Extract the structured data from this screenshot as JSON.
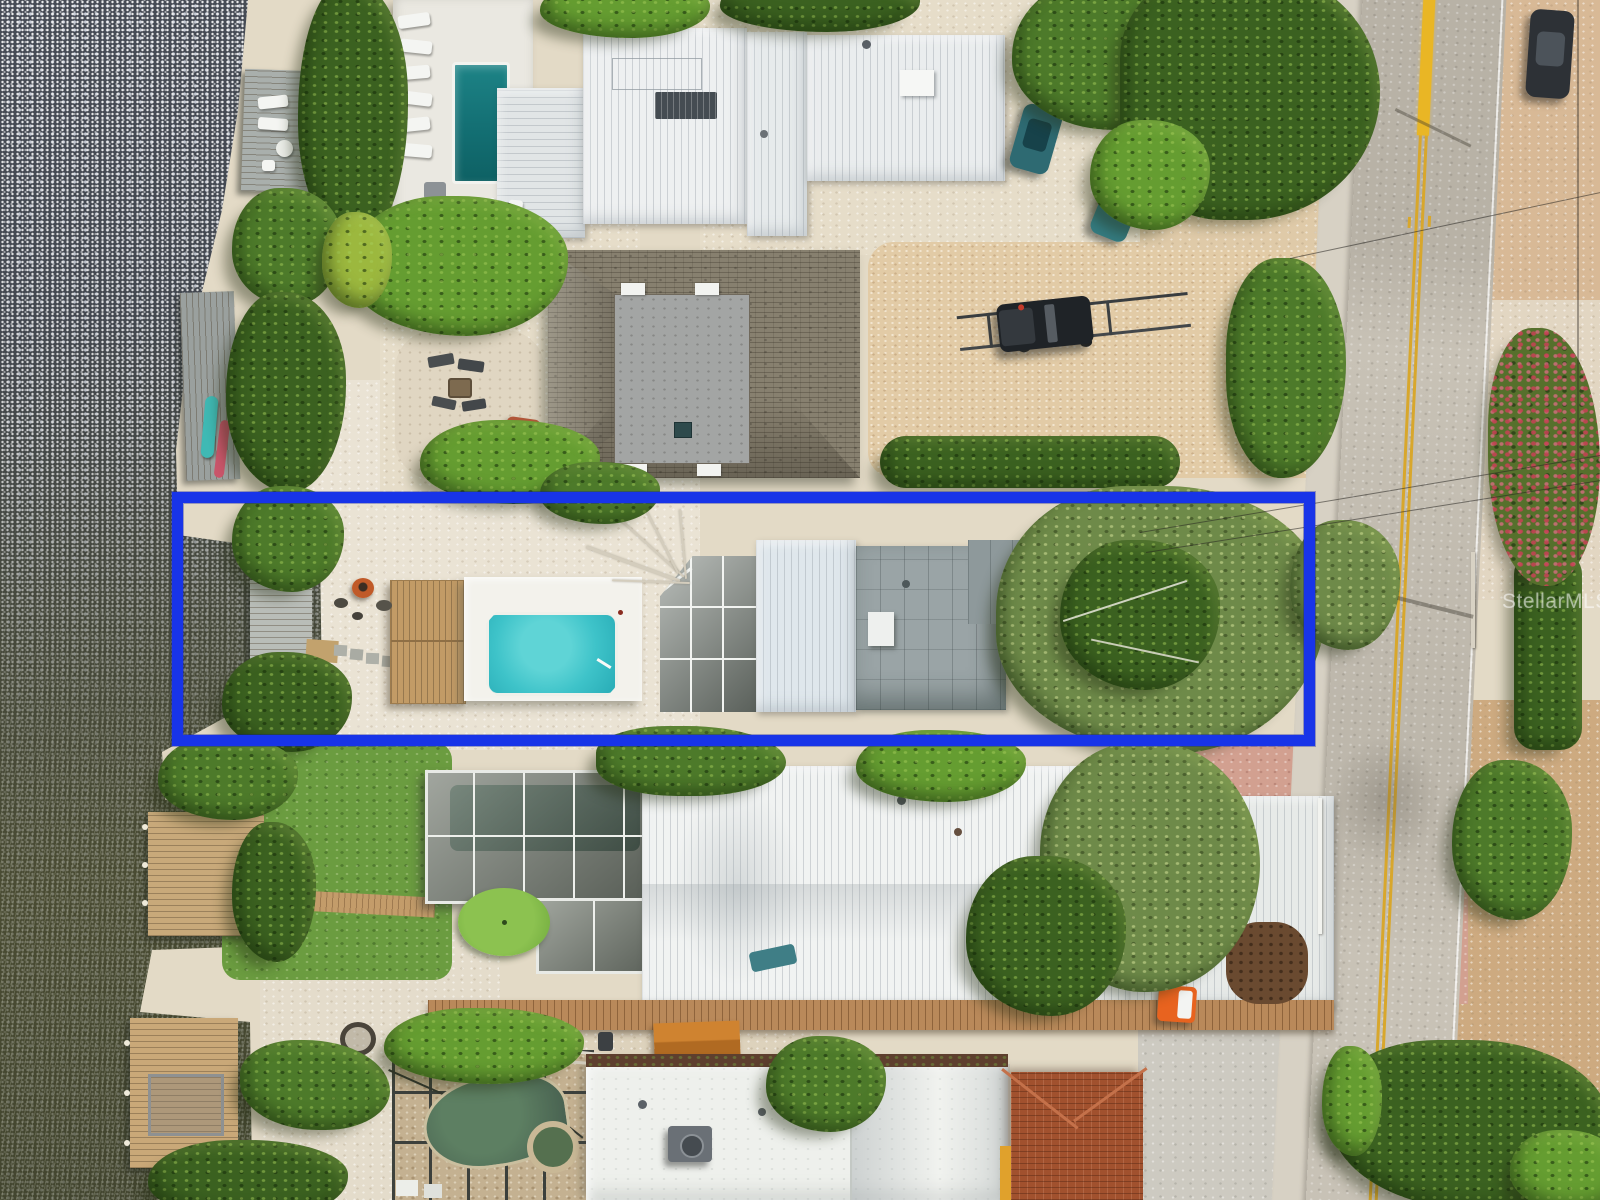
{
  "meta": {
    "description": "Aerial drone photograph of waterfront residential parcels; one lot is highlighted with a blue boundary rectangle",
    "width_px": 1600,
    "height_px": 1200
  },
  "watermark": {
    "text": "StellarMLS",
    "opacity": 0.5
  },
  "property_outline": {
    "shape": "rectangle",
    "color": "#1834e8",
    "left_px": 172,
    "top_px": 492,
    "width_px": 1143,
    "height_px": 254,
    "border_px": 11
  },
  "palette": {
    "water_dark_slate": "#474c56",
    "water_olive": "#4a4c33",
    "mangrove_green": "#4d7a2a",
    "sand_shell": "#e6ddc9",
    "pool_turquoise": "#3ec3c9",
    "lap_pool_teal": "#177a7d",
    "metal_roof_white": "#eef0f1",
    "shingle_roof_brown": "#87806f",
    "asphalt_gray": "#c8c2b6",
    "centerline_yellow": "#d8a72c",
    "paver_pink": "#d2a090",
    "terracotta_roof": "#a1512e",
    "boardwalk_tan": "#b9895a"
  }
}
